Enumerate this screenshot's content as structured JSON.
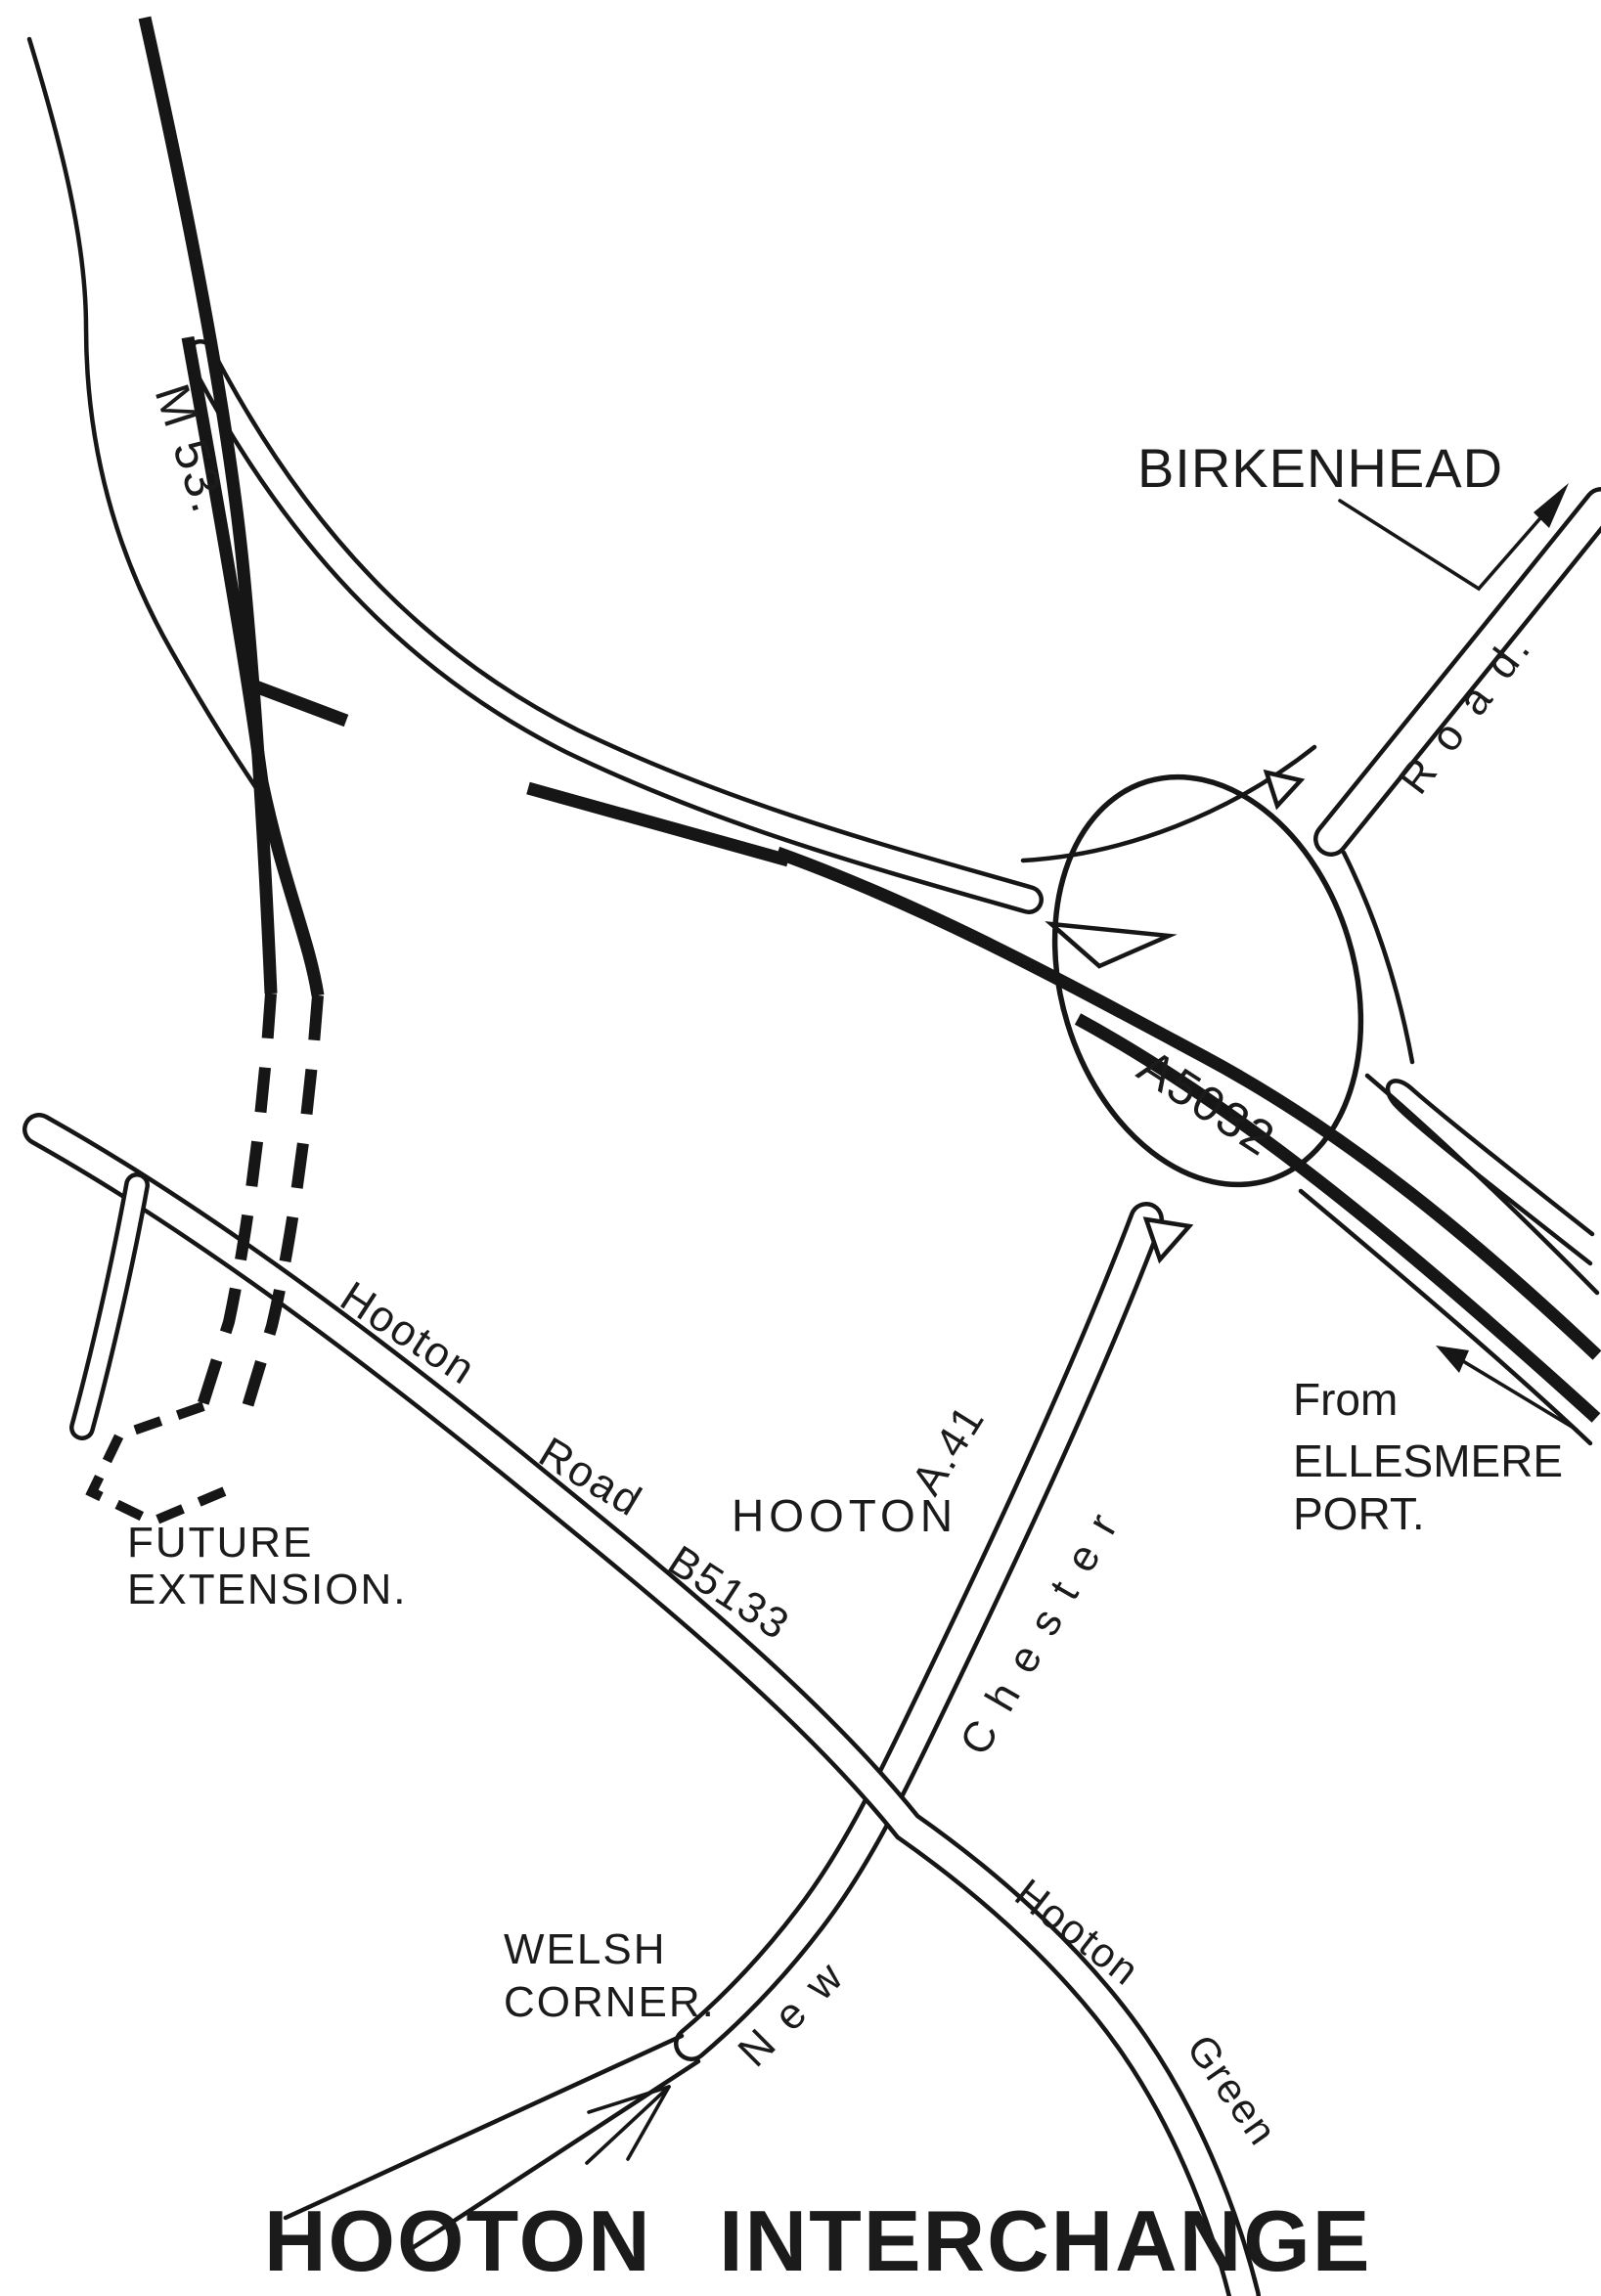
{
  "map": {
    "title": "HOOTON INTERCHANGE",
    "type": "hand-drawn road interchange diagram",
    "colors": {
      "ink": "#161616",
      "paper": "#ffffff"
    },
    "roads": [
      {
        "name": "M53 motorway",
        "style": "dual thick lines, dashed where unbuilt"
      },
      {
        "name": "A5032",
        "style": "heavy through route via roundabout"
      },
      {
        "name": "New Chester Road A.41",
        "style": "double-line road"
      },
      {
        "name": "Hooton Road B5133",
        "style": "double-line road"
      },
      {
        "name": "Hooton Green",
        "style": "double-line road"
      },
      {
        "name": "Road to Birkenhead",
        "style": "double-line road with arrow"
      }
    ],
    "junction": {
      "roundabout": true,
      "give_way_triangles": 3
    }
  },
  "labels": {
    "m53": {
      "text": "M 53."
    },
    "birkenhead": {
      "text": "BIRKENHEAD"
    },
    "road_word": {
      "text": "R o a d."
    },
    "a5032": {
      "text": "A5032"
    },
    "from": {
      "text": "From"
    },
    "ellesmere": {
      "text": "ELLESMERE"
    },
    "port": {
      "text": "PORT."
    },
    "future": {
      "text": "FUTURE"
    },
    "extension": {
      "text": "EXTENSION."
    },
    "hooton_rd": {
      "text": "Hooton"
    },
    "road_rd": {
      "text": "Road"
    },
    "b5133": {
      "text": "B5133"
    },
    "hooton_vlg": {
      "text": "HOOTON"
    },
    "a41": {
      "text": "A.41"
    },
    "chester": {
      "text": "C h e s t e r"
    },
    "new": {
      "text": "N e w"
    },
    "hooton_grn": {
      "text": "Hooton"
    },
    "green": {
      "text": "Green"
    },
    "welsh": {
      "text": "WELSH"
    },
    "corner": {
      "text": "CORNER."
    },
    "title": {
      "text": "HOOTON INTERCHANGE"
    }
  }
}
